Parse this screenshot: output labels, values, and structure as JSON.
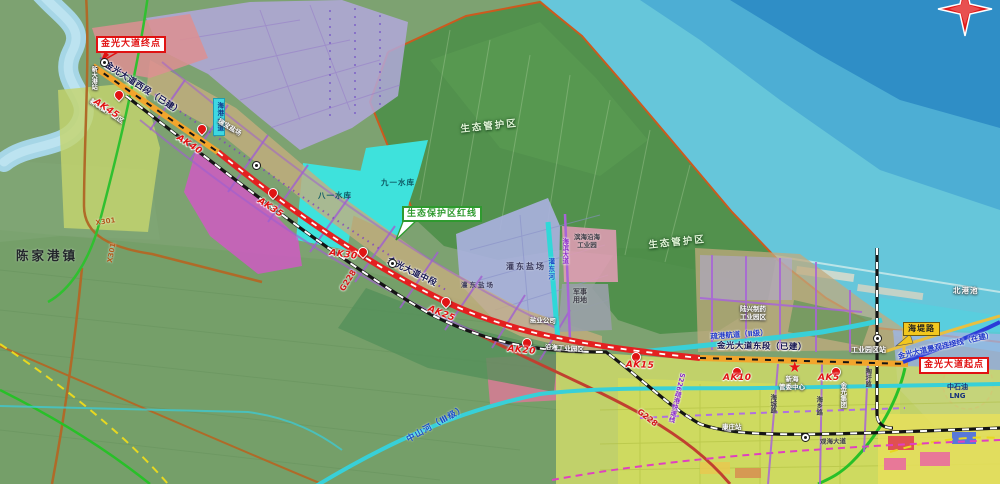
{
  "map": {
    "markers": {
      "endpoint": "金光大道终点",
      "startpoint": "金光大道起点",
      "eco_redline": "生态保护区红线",
      "seawall_road": "海堤路"
    },
    "roads": {
      "west_section": "金光大道西段（已建）",
      "mid_section": "金光大道中段",
      "east_section": "金光大道东段（已建）",
      "connection_line": "金光大道景观连接线（在建）",
      "g228": "G228",
      "x301": "X301",
      "s226": "S226疏港快速线",
      "haibin_avenue": "海滨大道",
      "haigang_avenue": "海港大道",
      "haixiang_road": "海乡路",
      "haicheng_road": "海城路",
      "taoxu_road": "陶圩路",
      "guanhai_avenue": "观海大道"
    },
    "water": {
      "shugang_channel": "疏港航道（Ⅱ级）",
      "zhongshan_river": "中山河（Ⅲ级）",
      "jiuyi_reservoir": "九一水库",
      "bayi_reservoir": "八一水库",
      "guandong_river": "灌东河",
      "north_basin": "北港池"
    },
    "zones": {
      "eco_zone": "生态管护区",
      "guandong_salt": "灌东盐场",
      "military_line1": "军事",
      "military_line2": "用地",
      "binhai_park_line1": "滨海沿海",
      "binhai_park_line2": "工业园",
      "luxing_line1": "陆兴制药",
      "luxing_line2": "工业园区",
      "lng_line1": "中石油",
      "lng_line2": "LNG",
      "xinzhuangbei_park": "新装备产业区",
      "ruibao_salt": "瑞宝盐场",
      "yanye_company": "盐业公司",
      "yanhai_park": "沿海工业园区",
      "jinguang_group": "金光集团",
      "chenjiagang_town": "陈家港镇",
      "xinhai_line1": "新海",
      "xinhai_line2": "管委中心"
    },
    "stations": {
      "xindagang": "新大港站",
      "gongyeyuanqu": "工业园区站",
      "kangzhuang": "康庄站"
    },
    "chainage": [
      "AK45",
      "AK40",
      "AK35",
      "AK30",
      "AK25",
      "AK20",
      "AK15",
      "AK10",
      "AK5"
    ]
  },
  "colors": {
    "road_built": "#f2a52c",
    "road_planned": "#e42020",
    "road_in_construction": "#2a3cd8",
    "waterway": "#38d0d8",
    "sea_deep": "#2f8ec6",
    "eco_green": "#4f8f4a",
    "salt_field_lavender": "#a9b1dd",
    "industry_pink": "#e09cb4",
    "corridor_tan": "#c6ad7e",
    "farmland_yellow": "#ccd968",
    "marker_red": "#e01212"
  }
}
